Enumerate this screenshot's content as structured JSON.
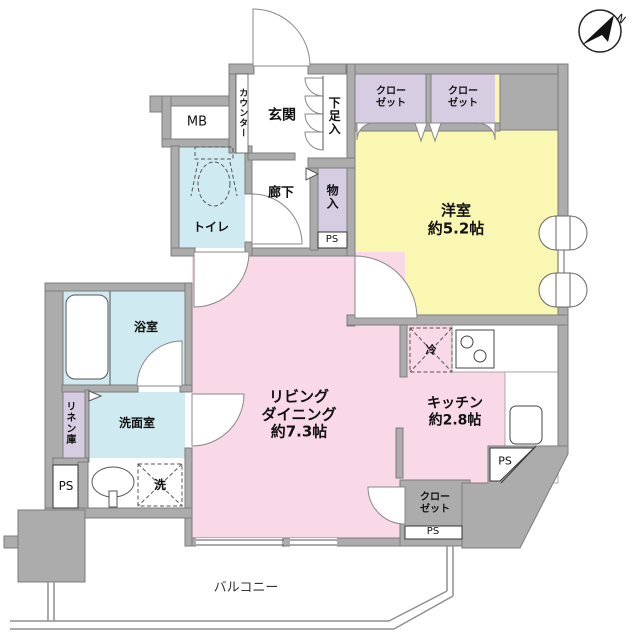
{
  "compass": {
    "label": "N"
  },
  "colors": {
    "wall": "#ACACAC",
    "living": "#F9D8E7",
    "bedroom": "#F9F7B2",
    "wet_area": "#CFEAF0",
    "closet": "#D6CDE3"
  },
  "rooms": {
    "mb": {
      "label": "MB"
    },
    "counter": {
      "label": "カウンター"
    },
    "entrance": {
      "label": "玄関"
    },
    "shoe_storage": {
      "label": "下足入"
    },
    "closet_left": {
      "lines": [
        "クロー",
        "ゼット"
      ]
    },
    "closet_right": {
      "lines": [
        "クロー",
        "ゼット"
      ]
    },
    "western_room": {
      "lines": [
        "洋室",
        "約5.2帖"
      ]
    },
    "hallway": {
      "label": "廊下"
    },
    "storage": {
      "label": "物入"
    },
    "toilet": {
      "label": "トイレ"
    },
    "bathroom": {
      "label": "浴室"
    },
    "linen_closet": {
      "label": "リネン庫"
    },
    "washroom": {
      "label": "洗面室"
    },
    "washer": {
      "label": "洗"
    },
    "refrigerator": {
      "label": "冷"
    },
    "living_dining": {
      "lines": [
        "リビング",
        "ダイニング",
        "約7.3帖"
      ]
    },
    "kitchen": {
      "lines": [
        "キッチン",
        "約2.8帖"
      ]
    },
    "closet_bottom": {
      "lines": [
        "クロー",
        "ゼット"
      ]
    },
    "balcony": {
      "label": "バルコニー"
    }
  },
  "ps": {
    "hallway": "PS",
    "washroom": "PS",
    "kitchen": "PS",
    "closet": "PS"
  }
}
